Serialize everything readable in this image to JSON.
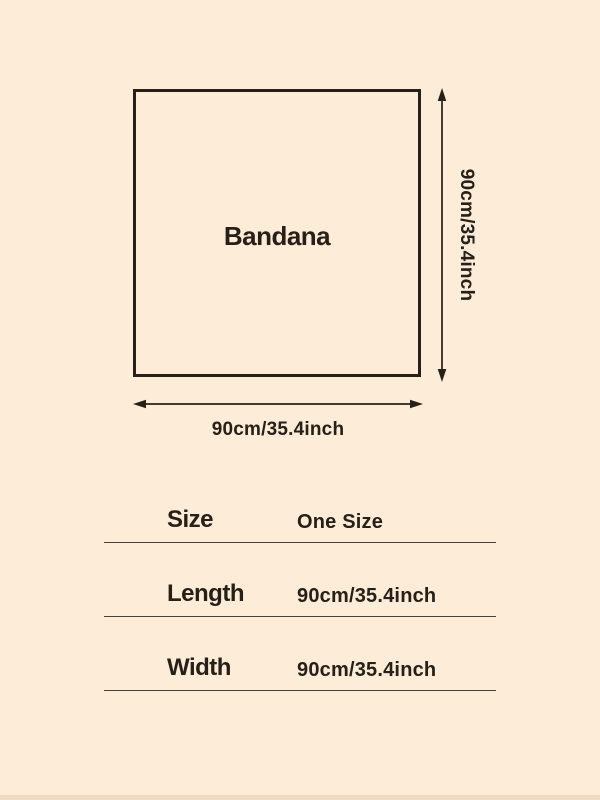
{
  "diagram": {
    "product_label": "Bandana",
    "height_dimension": "90cm/35.4inch",
    "width_dimension": "90cm/35.4inch"
  },
  "size_table": {
    "rows": [
      {
        "label": "Size",
        "value": "One Size"
      },
      {
        "label": "Length",
        "value": "90cm/35.4inch"
      },
      {
        "label": "Width",
        "value": "90cm/35.4inch"
      }
    ]
  },
  "colors": {
    "background": "#fcecd8",
    "ink": "#262019",
    "divider": "#45403a",
    "edge": "#f0dbc2"
  }
}
